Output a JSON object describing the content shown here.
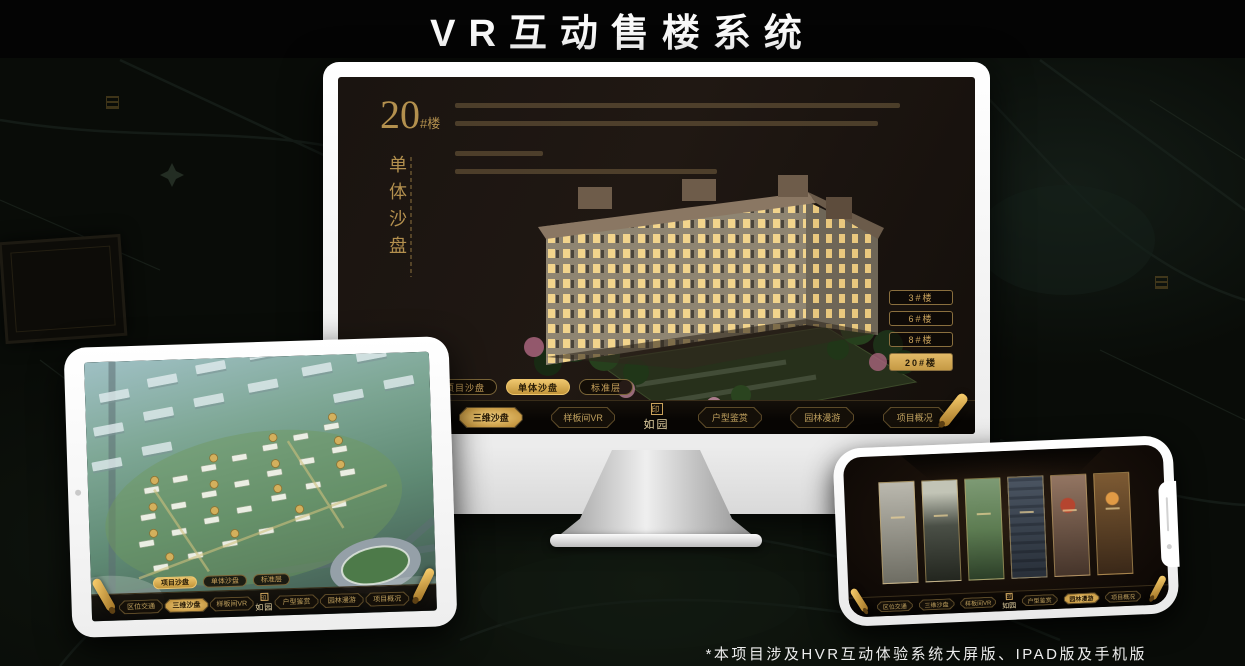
{
  "page": {
    "title": "VR互动售楼系统",
    "footnote": "*本项目涉及HVR互动体验系统大屏版、IPAD版及手机版"
  },
  "app": {
    "logo": "如园",
    "logo_seal": "印",
    "tabs": [
      "项目沙盘",
      "单体沙盘",
      "标准层"
    ],
    "nav_items": [
      "区位交通",
      "三维沙盘",
      "样板间VR",
      "户型鉴赏",
      "园林漫游",
      "项目概况"
    ]
  },
  "monitor": {
    "block_number": "20",
    "block_suffix": "#楼",
    "block_name": "单体沙盘",
    "floor_buttons": [
      "3#楼",
      "6#楼",
      "8#楼",
      "20#楼"
    ],
    "active_floor": "20#楼",
    "active_tab": "单体沙盘",
    "active_nav": "三维沙盘"
  },
  "tablet": {
    "active_tab": "项目沙盘",
    "active_nav": "三维沙盘"
  },
  "phone": {
    "active_nav": "园林漫游"
  },
  "colors": {
    "gold": "#c9a25c",
    "gold_bright": "#eec66d",
    "screen_bg": "#1a1410",
    "page_bg": "#090c08"
  }
}
